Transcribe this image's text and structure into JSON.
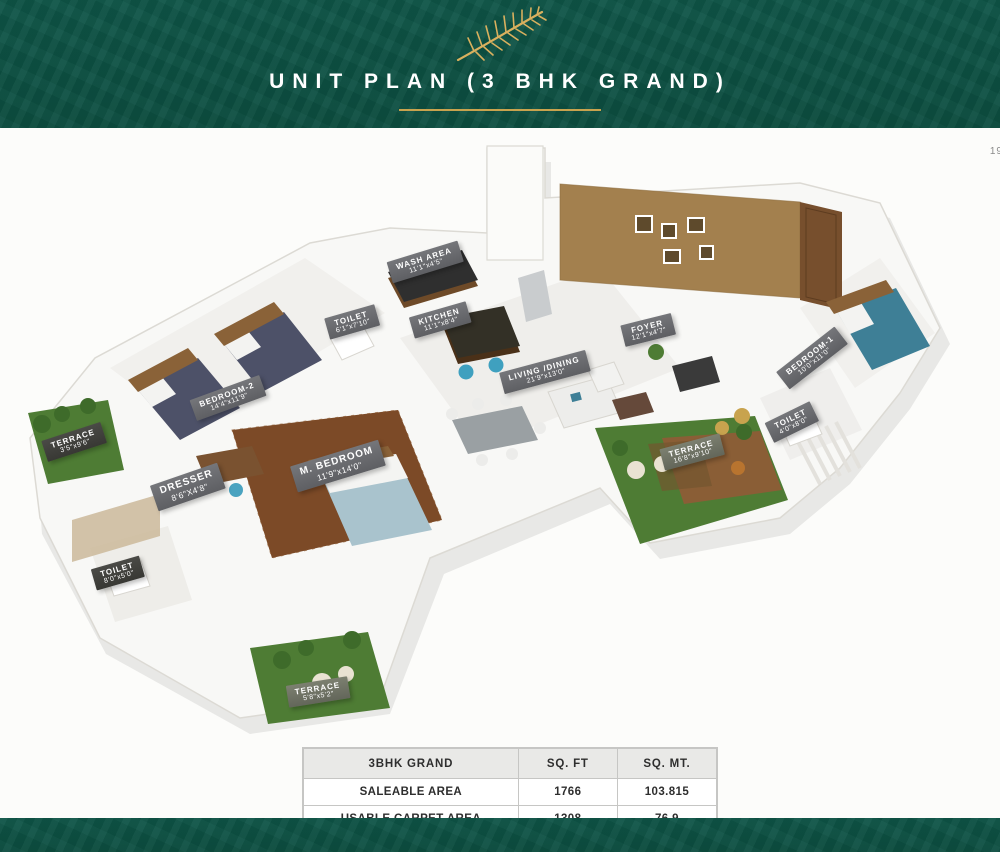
{
  "page": {
    "corner_note": "19"
  },
  "header": {
    "title": "UNIT PLAN (3 BHK GRAND)",
    "logo": "gold-fern-leaf",
    "accent_color": "#c8a34e",
    "bg_color": "#0d5244"
  },
  "floorplan": {
    "description": "3D isometric unit plan render, 3 BHK Grand",
    "rooms": [
      {
        "name": "BEDROOM-2",
        "dims": "14'4\"x11'9\""
      },
      {
        "name": "WASH AREA",
        "dims": "11'1\"x4'5\""
      },
      {
        "name": "TOILET",
        "dims": "6'1\"x7'10\""
      },
      {
        "name": "KITCHEN",
        "dims": "11'1\"x8'4\""
      },
      {
        "name": "LIVING /DINING",
        "dims": "21'9\"x13'0\""
      },
      {
        "name": "FOYER",
        "dims": "12'1\"x4'7\""
      },
      {
        "name": "BEDROOM-1",
        "dims": "10'0\"x11'0\""
      },
      {
        "name": "TOILET",
        "dims": "4'0\"x8'0\""
      },
      {
        "name": "TERRACE",
        "dims": "16'8\"x9'10\""
      },
      {
        "name": "TERRACE",
        "dims": "3'5\"x9'6\""
      },
      {
        "name": "DRESSER",
        "dims": "8'6\"X4'8\""
      },
      {
        "name": "M. BEDROOM",
        "dims": "11'9\"x14'0\""
      },
      {
        "name": "TOILET",
        "dims": "8'0\"x5'0\""
      },
      {
        "name": "TERRACE",
        "dims": "5'8\"x5'2\""
      }
    ]
  },
  "table": {
    "headers": [
      "3BHK GRAND",
      "SQ. FT",
      "SQ. MT."
    ],
    "rows": [
      {
        "label": "SALEABLE AREA",
        "sqft": "1766",
        "sqmt": "103.815"
      },
      {
        "label": "USABLE CARPET AREA",
        "sqft": "1308",
        "sqmt": "76.9"
      },
      {
        "label": "CARPET AREA AS PER RERA (EXCLUDING TERRACE)",
        "sqft": "1123.21",
        "sqmt": "63.52"
      }
    ]
  }
}
